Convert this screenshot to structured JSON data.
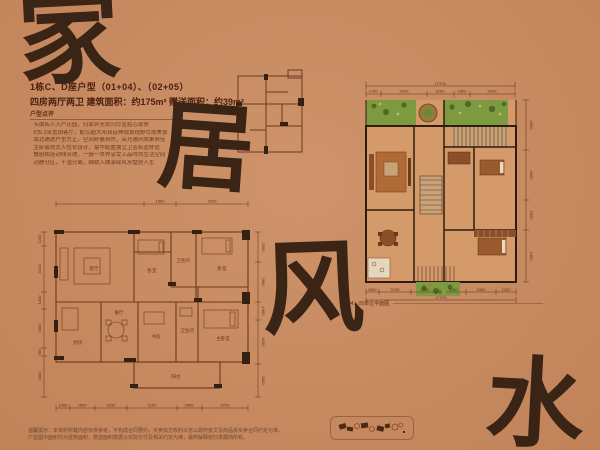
{
  "page": {
    "bg": "#c98a60",
    "ink": "#3a2415",
    "accent_green": "#7d9a40",
    "line_brown": "#6b3a1e",
    "wall_dark": "#2e1c0e"
  },
  "calligraphy": {
    "jia": "家",
    "ju": "居",
    "feng": "风",
    "shui": "水"
  },
  "header": {
    "title": "1栋C、D座户型（01+04）、（02+05）",
    "subtitle": "四房两厅两卫  建筑面积：约175m²  赠送面积：约39m²"
  },
  "review": {
    "heading": "户型点评",
    "bullets": [
      "专属私人入户花园，归家宾至如归尽显贴心尊贵",
      "约5.2米宽阔客厅，配以超大阳台延伸观景视野尽揽美景",
      "南北通透户型方正，空间舒展自然，采光通风效果俱佳",
      "主卧套房式人性化设计，豪华配置独立卫浴私密舒适",
      "餐厨相连动线合理，一厨一世界享受上品时尚生活空间",
      "动静分区，干湿分离，细致入微演绎风水墅居人生"
    ]
  },
  "main_plan": {
    "caption": "04、05单位平面图",
    "total_top": "17375",
    "dims_top": [
      "1700",
      "5240",
      "3100",
      "1800",
      "5100"
    ],
    "total_bottom": "17375",
    "dims_bottom": [
      "1500",
      "3700",
      "3300",
      "3050",
      "3450",
      "2320"
    ],
    "dims_right": [
      "4300",
      "4400",
      "1600",
      "2400"
    ]
  },
  "left_plan": {
    "dims_top": [
      "1500",
      "4200"
    ],
    "rooms": {
      "living": "客厅",
      "bedroom1": "卧室",
      "bath1": "卫生间",
      "bedroom2": "卧室",
      "kitchen": "厨房",
      "dining": "餐厅",
      "study": "书房",
      "bath2": "卫生间",
      "master": "主卧室",
      "balcony": "阳台"
    },
    "dims_bottom": [
      "1400",
      "2600",
      "3290",
      "5100",
      "2600",
      "4700"
    ],
    "dims_left": [
      "1200",
      "4100",
      "1400",
      "3400",
      "650",
      "3400"
    ],
    "dims_right": [
      "2300",
      "3600",
      "1400",
      "4100",
      "2400"
    ]
  },
  "disclaimer": {
    "line1": "温馨提示：本资料所载内容仅供参考，不构成合同要约，买卖双方权利义务以政府批文及商品房买卖合同约定为准。",
    "line2": "户型图中面积均为建筑面积，赠送面积数据以实际交付及相关约定为准，最终解释权归发展商所有。"
  }
}
